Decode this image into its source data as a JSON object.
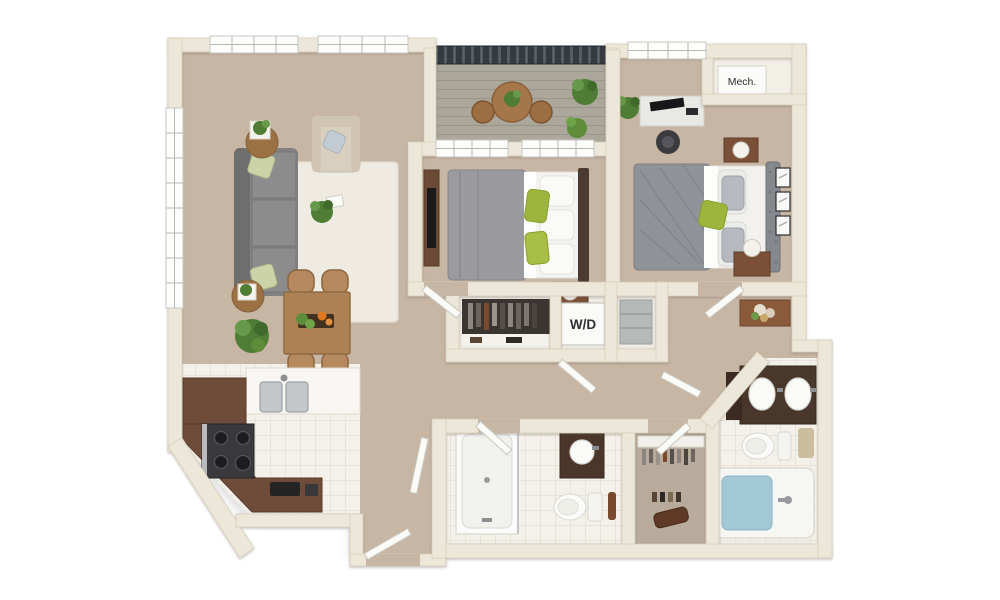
{
  "image": {
    "type": "3d-floor-plan",
    "background": "#ffffff"
  },
  "labels": {
    "mech_room": "Mech.",
    "washer_dryer": "W/D"
  },
  "palette": {
    "background": "#ffffff",
    "wall": "#ece7d8",
    "wall_edge": "#d6cfbc",
    "carpet": "#c8b6a4",
    "carpet_dark": "#b9ab9b",
    "tile": "#f4f1ea",
    "tile_line": "#ddd7ca",
    "balcony_floor": "#aca79b",
    "railing": "#343a3f",
    "cabinet_brown": "#6e4c39",
    "wood": "#ad8154",
    "sofa_gray": "#828282",
    "bed_gray": "#9b9b9f",
    "headboard_gray": "#85888c",
    "accent_green": "#9db53c",
    "plant_green": "#4f7d36",
    "tub_water": "#a3c8d6",
    "fixture_white": "#fbfbf9",
    "closet_dark": "#3a3531",
    "label_text": "#2e2e2e"
  },
  "rooms": [
    "living-room",
    "dining-area",
    "kitchen",
    "balcony",
    "bedroom-1",
    "bedroom-2",
    "mech-closet",
    "laundry-closet",
    "linen-closet",
    "hallway",
    "bathroom-1",
    "walk-in-closet",
    "bathroom-2",
    "entry"
  ],
  "furniture": [
    "sofa",
    "armchair",
    "area-rug",
    "coffee-table-plant",
    "round-side-tables",
    "dining-table",
    "dining-chairs",
    "floor-plant",
    "kitchen-double-sink",
    "range-stove",
    "counter-appliances",
    "washer-dryer-unit",
    "mech-unit",
    "bed-1",
    "dresser-with-tv",
    "nightstand-lamp",
    "desk-with-monitor",
    "office-chair",
    "bed-2",
    "wall-frames",
    "console-with-flowers",
    "shower-stall",
    "vanity-sink",
    "toilet",
    "double-vanity",
    "bathtub",
    "closet-bench",
    "balcony-table",
    "balcony-plants",
    "open-doors"
  ]
}
